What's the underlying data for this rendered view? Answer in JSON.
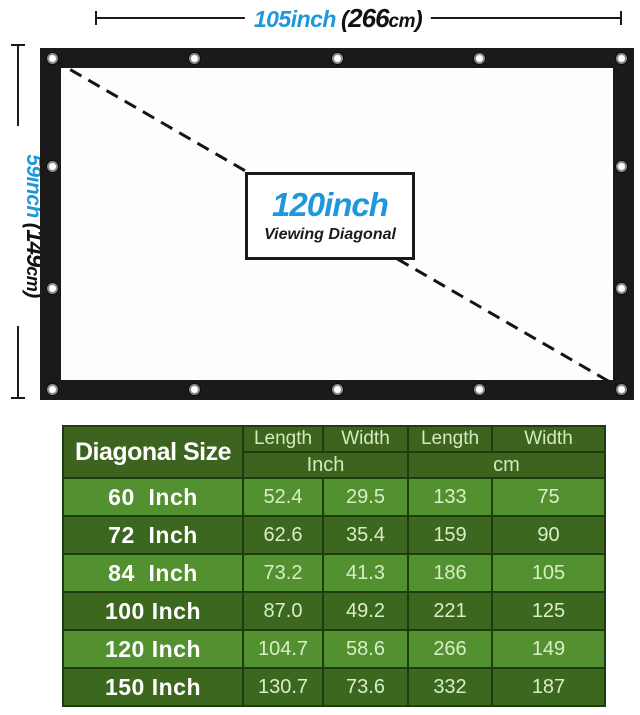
{
  "colors": {
    "accent_blue": "#1f97dc",
    "frame_black": "#1a1a1a",
    "table_header_green": "#3c641e",
    "table_row_dark_green": "#3c671f",
    "table_row_light_green": "#529030",
    "table_border_green": "#1e3c0e",
    "table_value_text": "#d9eec6",
    "table_label_text": "#ffffff"
  },
  "top_dimension": {
    "inch_label": "105inch",
    "paren_open": "(",
    "cm_value": "266",
    "cm_unit": "cm",
    "paren_close": ")"
  },
  "left_dimension": {
    "inch_label": "59inch",
    "paren_open": "(",
    "cm_value": "149",
    "cm_unit": "cm",
    "paren_close": ")"
  },
  "diagonal_label": {
    "size": "120inch",
    "caption": "Viewing Diagonal"
  },
  "table": {
    "header": {
      "diagonal": "Diagonal Size",
      "cols": [
        "Length",
        "Width",
        "Length",
        "Width"
      ],
      "units": [
        "Inch",
        "cm"
      ]
    },
    "rows": [
      {
        "label": "60  Inch",
        "inch_length": "52.4",
        "inch_width": "29.5",
        "cm_length": "133",
        "cm_width": "75"
      },
      {
        "label": "72  Inch",
        "inch_length": "62.6",
        "inch_width": "35.4",
        "cm_length": "159",
        "cm_width": "90"
      },
      {
        "label": "84  Inch",
        "inch_length": "73.2",
        "inch_width": "41.3",
        "cm_length": "186",
        "cm_width": "105"
      },
      {
        "label": "100 Inch",
        "inch_length": "87.0",
        "inch_width": "49.2",
        "cm_length": "221",
        "cm_width": "125"
      },
      {
        "label": "120 Inch",
        "inch_length": "104.7",
        "inch_width": "58.6",
        "cm_length": "266",
        "cm_width": "149"
      },
      {
        "label": "150 Inch",
        "inch_length": "130.7",
        "inch_width": "73.6",
        "cm_length": "332",
        "cm_width": "187"
      }
    ]
  }
}
